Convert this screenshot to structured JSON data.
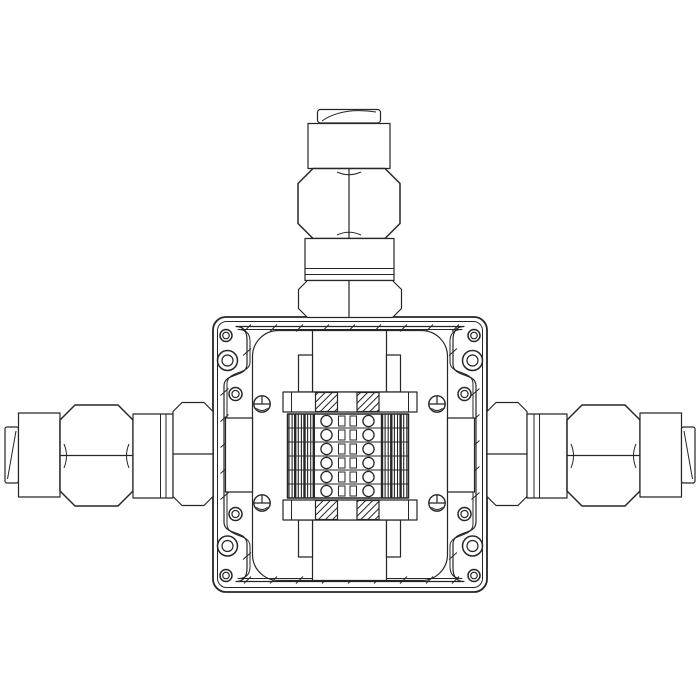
{
  "meta": {
    "description": "Technical line drawing of an explosion-proof junction box with internal terminal strip and three cable glands (top, left, right)",
    "background_color": "#ffffff",
    "line_color": "#262626"
  },
  "components": {
    "junction_box": "square enclosure with rounded corners, gasket seam and mounting flanges",
    "glands": [
      {
        "position": "top"
      },
      {
        "position": "left"
      },
      {
        "position": "right"
      }
    ],
    "terminal_strip": {
      "rows": 6,
      "screw_columns": 2,
      "x": 287.5,
      "y": 414,
      "width": 121,
      "height": 84,
      "screw_col_x": [
        326.5,
        368.5
      ],
      "screw_radius": 5.6,
      "mid_rects_x": [
        338.5,
        350
      ],
      "mid_rect_w": 6.5,
      "mid_rect_h": 10,
      "dense_blocks": [
        {
          "x0": 289,
          "step": 3.1,
          "count": 9,
          "thick_idx": [
            2,
            5,
            8
          ]
        },
        {
          "x0": 382,
          "step": 3.1,
          "count": 9,
          "thick_idx": [
            0,
            3,
            6
          ]
        }
      ]
    },
    "mounting_holes": [
      {
        "cx": 226,
        "cy": 335.5,
        "r": 6
      },
      {
        "cx": 227.5,
        "cy": 360.5,
        "r": 10
      },
      {
        "cx": 235.5,
        "cy": 394,
        "r": 6.5
      },
      {
        "cx": 235.5,
        "cy": 514,
        "r": 6.5
      },
      {
        "cx": 227.5,
        "cy": 546,
        "r": 10
      },
      {
        "cx": 226,
        "cy": 575.5,
        "r": 6
      },
      {
        "cx": 474,
        "cy": 335.5,
        "r": 6
      },
      {
        "cx": 472.5,
        "cy": 360.5,
        "r": 10
      },
      {
        "cx": 464.5,
        "cy": 394,
        "r": 6.5
      },
      {
        "cx": 464.5,
        "cy": 514,
        "r": 6.5
      },
      {
        "cx": 472.5,
        "cy": 546,
        "r": 10
      },
      {
        "cx": 474,
        "cy": 575.5,
        "r": 6
      }
    ],
    "cover_screws": [
      {
        "cx": 262,
        "cy": 404
      },
      {
        "cx": 437,
        "cy": 404
      },
      {
        "cx": 262,
        "cy": 503
      },
      {
        "cx": 437,
        "cy": 503
      }
    ],
    "seam_ticks": {
      "spacing": 26,
      "top": {
        "y": 328,
        "x0": 248,
        "x1": 456
      },
      "bottom": {
        "y": 580,
        "x0": 248,
        "x1": 456
      },
      "left": {
        "x": 224.5,
        "y0": 392,
        "y1": 518
      },
      "right": {
        "x": 475.5,
        "y0": 392,
        "y1": 518
      },
      "bulge_ticks": [
        {
          "x": 247,
          "y": 352
        },
        {
          "x": 453,
          "y": 352
        },
        {
          "x": 247,
          "y": 556
        },
        {
          "x": 453,
          "y": 556
        }
      ]
    }
  }
}
